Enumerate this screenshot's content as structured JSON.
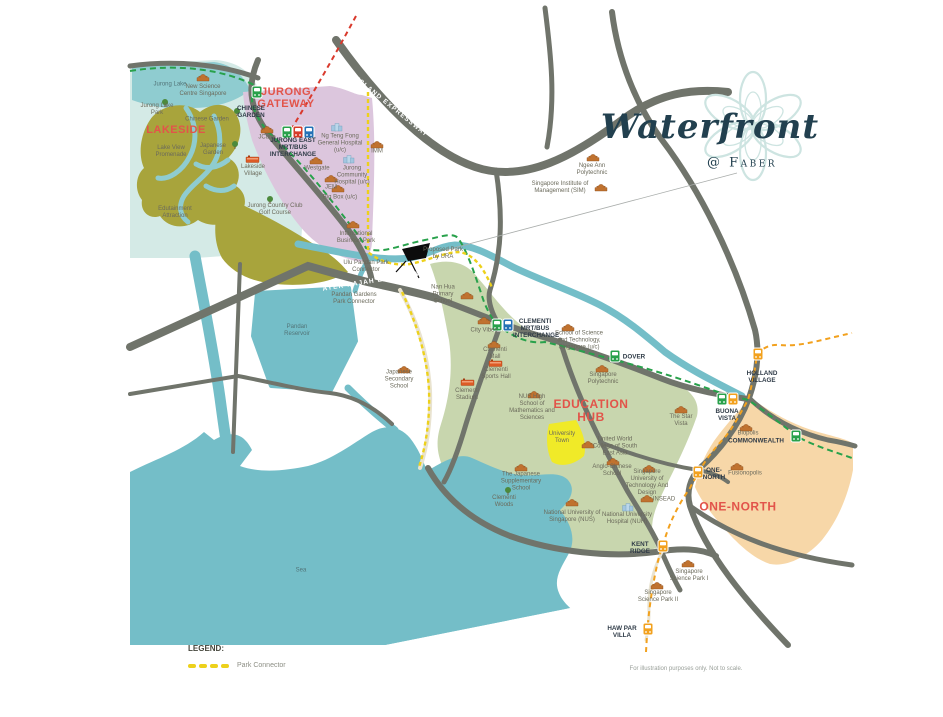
{
  "logo": {
    "title": "Waterfront",
    "subtitle": "@ Faber"
  },
  "region_labels": {
    "lakeside": "LAKESIDE",
    "jurong_gateway": "JURONG GATEWAY",
    "education_hub": "EDUCATION HUB",
    "one_north": "ONE-NORTH"
  },
  "roads": {
    "pie": "PAN ISLAND EXPRESSWAY",
    "aye": "AYER RAJAH EXPRESSWAY"
  },
  "stations": {
    "chinese_garden": "CHINESE GARDEN",
    "jurong_east": "JURONG EAST MRT/BUS INTERCHANGE",
    "clementi": "CLEMENTI MRT/BUS INTERCHANGE",
    "dover": "DOVER",
    "holland_village": "HOLLAND VILLAGE",
    "buona_vista": "BUONA VISTA",
    "commonwealth": "COMMONWEALTH",
    "one_north": "ONE-NORTH",
    "kent_ridge": "KENT RIDGE",
    "haw_par_villa": "HAW PAR VILLA"
  },
  "places": {
    "jurong_lake": "Jurong Lake",
    "new_science_centre": "New Science Centre Singapore",
    "jurong_lake_park": "Jurong Lake Park",
    "chinese_garden": "Chinese Garden",
    "japanese_garden": "Japanese Garden",
    "lake_view_promenade": "Lake View Promenade",
    "edutainment_attraction": "Edutainment Attraction",
    "lakeside_village": "Lakeside Village",
    "jurong_country_club": "Jurong Country Club Golf Course",
    "jcube": "JCube",
    "westgate": "Westgate",
    "jem": "JEM",
    "big_box": "Big Box (u/c)",
    "imm": "IMM",
    "ng_teng_fong": "Ng Teng Fong General Hospital (u/c)",
    "jurong_community_hospital": "Jurong Community Hospital (u/c)",
    "international_business_park": "International Business Park",
    "ngee_ann_polytechnic": "Ngee Ann Polytechnic",
    "sim": "Singapore Institute of Management (SIM)",
    "nan_hua": "Nan Hua Primary School",
    "japanese_secondary": "Japanese Secondary School",
    "city_vibes": "City Vibes",
    "clementi_mall": "Clementi Mall",
    "clementi_sports_hall": "Clementi Sports Hall",
    "clementi_stadium": "Clementi Stadium",
    "sst": "School of Science and Technology, Singapore (u/c)",
    "singapore_polytechnic": "Singapore Polytechnic",
    "nus_high": "NUS High School of Mathematics and Sciences",
    "university_town": "University Town",
    "uwc": "United World College of South East Asia",
    "anglo_chinese": "Anglo-Chinese School",
    "sutd": "Singapore University of Technology And Design",
    "insead": "INSEAD",
    "japanese_supplementary": "The Japanese Supplementary School",
    "clementi_woods": "Clementi Woods",
    "nus": "National University of Singapore (NUS)",
    "nuh": "National University Hospital (NUH)",
    "star_vista": "The Star Vista",
    "biopolis": "Biopolis",
    "fusionopolis": "Fusionopolis",
    "science_park_1": "Singapore Science Park I",
    "science_park_2": "Singapore Science Park II",
    "sea": "Sea",
    "pandan_reservoir": "Pandan Reservoir",
    "ulu_pandan_pc": "Ulu Pandan Park Connector",
    "pandan_gardens_pc": "Pandan Gardens Park Connector",
    "proposed_park": "Proposed Park by URA"
  },
  "legend": {
    "title": "LEGEND:",
    "park_connector": "Park Connector"
  },
  "footer": {
    "disclaimer": "For illustration purposes only. Not to scale."
  },
  "colors": {
    "water": "#74bec8",
    "ew_mrt_line": "#28a14b",
    "future_mrt_line": "#d9392c",
    "circle_mrt_line": "#f2a11e",
    "park_connector": "#edd11b",
    "education_hub_fill": "#c8d6ae",
    "one_north_fill": "#f7d7a8",
    "jurong_gateway_fill": "#dcc6dd",
    "university_town_fill": "#f0ea28",
    "region_label_red": "#e2544a"
  }
}
